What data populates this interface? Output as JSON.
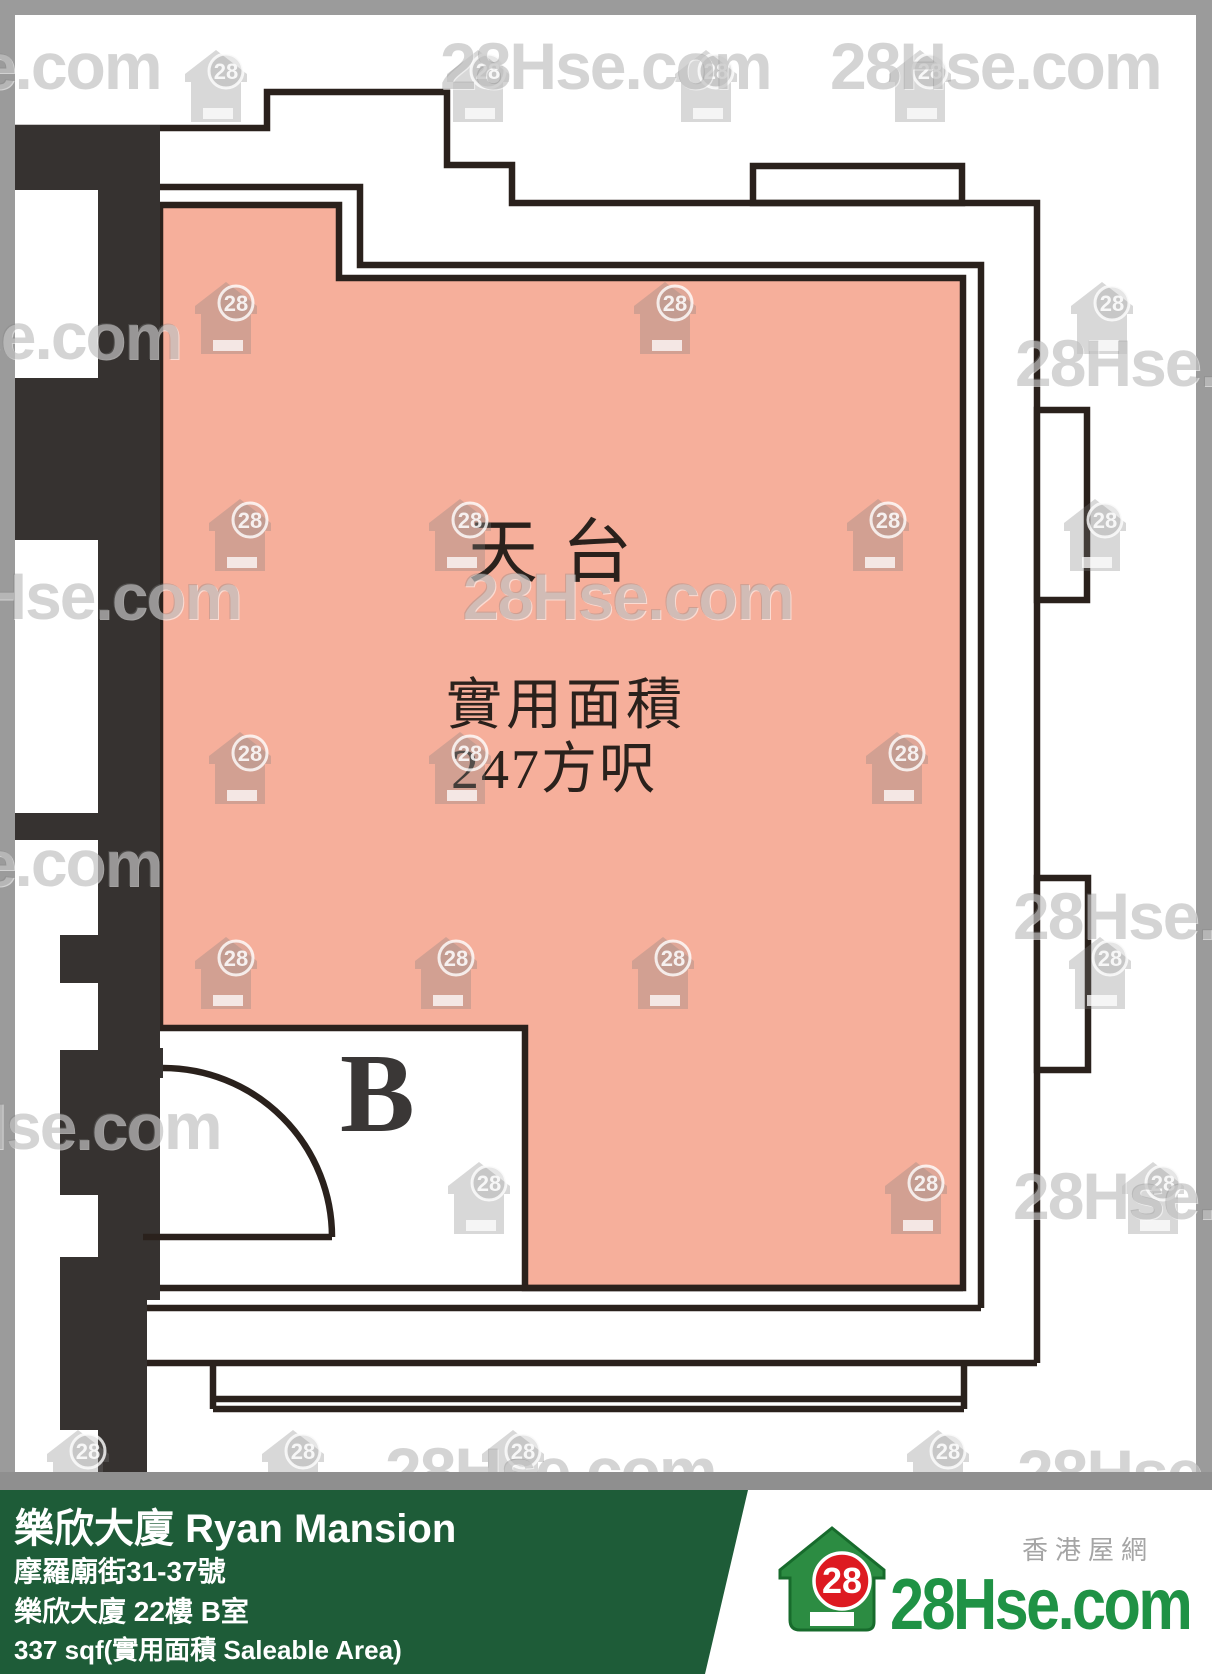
{
  "plan": {
    "room_label": "天台",
    "area_title": "實用面積",
    "area_value": "247方呎",
    "unit_letter": "B"
  },
  "watermark": {
    "text": "28Hse.com",
    "badge": "28",
    "texts": [
      [
        -170,
        28
      ],
      [
        440,
        28
      ],
      [
        830,
        28
      ],
      [
        -150,
        298
      ],
      [
        1015,
        325
      ],
      [
        -90,
        558
      ],
      [
        462,
        558
      ],
      [
        -170,
        825
      ],
      [
        1013,
        878
      ],
      [
        -110,
        1088
      ],
      [
        1013,
        1158
      ],
      [
        -330,
        1388
      ],
      [
        385,
        1433
      ],
      [
        1017,
        1435
      ]
    ],
    "houses": [
      [
        183,
        48
      ],
      [
        445,
        48
      ],
      [
        673,
        48
      ],
      [
        887,
        48
      ],
      [
        193,
        280
      ],
      [
        632,
        280
      ],
      [
        1069,
        280
      ],
      [
        207,
        497
      ],
      [
        427,
        497
      ],
      [
        845,
        497
      ],
      [
        1062,
        497
      ],
      [
        207,
        730
      ],
      [
        427,
        730
      ],
      [
        864,
        730
      ],
      [
        193,
        935
      ],
      [
        413,
        935
      ],
      [
        630,
        935
      ],
      [
        1067,
        935
      ],
      [
        446,
        1160
      ],
      [
        883,
        1160
      ],
      [
        1120,
        1160
      ],
      [
        45,
        1428
      ],
      [
        260,
        1428
      ],
      [
        480,
        1428
      ],
      [
        905,
        1428
      ]
    ]
  },
  "footer": {
    "title": "樂欣大廈 Ryan Mansion",
    "address": "摩羅廟街31-37號",
    "unit": "樂欣大廈 22樓 B室",
    "area": "337 sqf(實用面積 Saleable Area)"
  },
  "logo": {
    "badge": "28",
    "site": "28Hse.com",
    "tagline": "香港屋網"
  },
  "colors": {
    "rooftop_fill": "#f6af9b",
    "wall_line": "#2a211c",
    "wall_solid": "#363230",
    "frame_gray": "#9b9b9b",
    "divider_gray": "#8f8f8f",
    "footer_green": "#1e5c38",
    "logo_green": "#1f9245",
    "logo_red": "#dd1a21",
    "watermark_gray": "#808080"
  }
}
